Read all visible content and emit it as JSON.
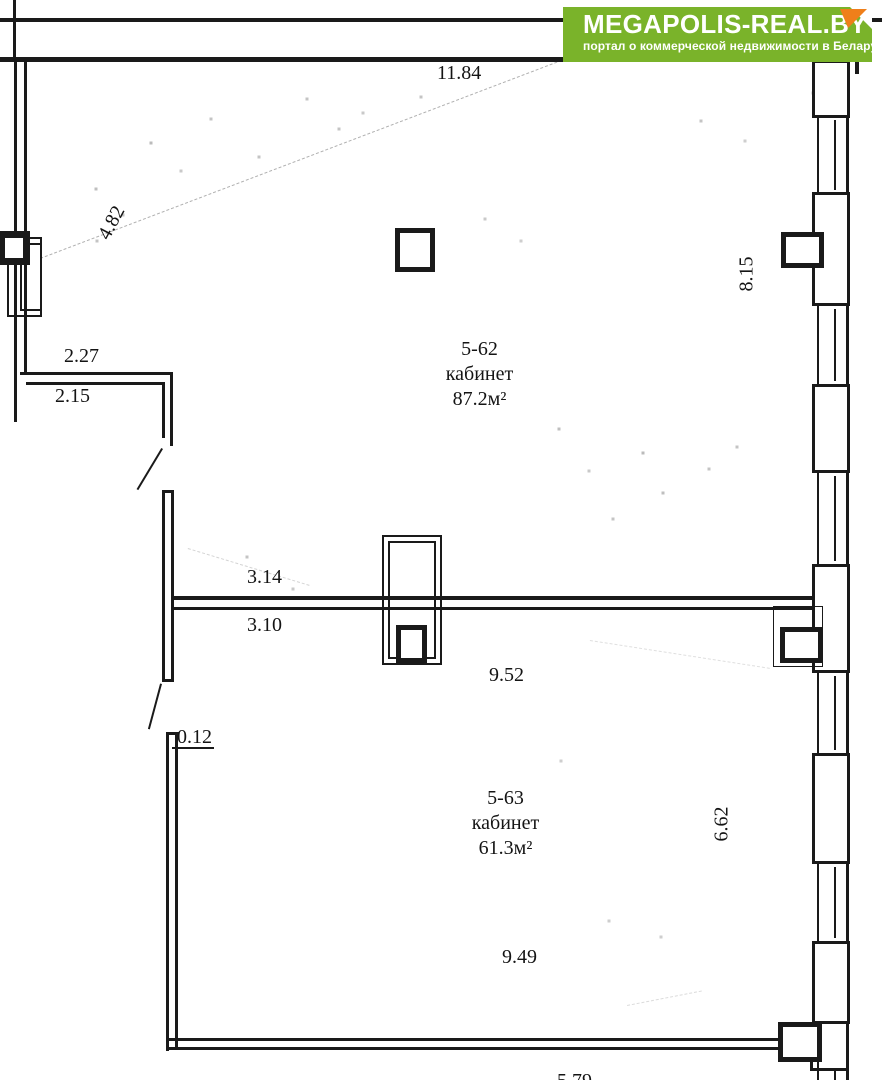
{
  "logo": {
    "title": "MEGAPOLIS-REAL.BY",
    "subtitle": "портал о коммерческой недвижимости в Беларуси",
    "background": "#7ab32a",
    "fold": "#ef7f1a"
  },
  "rooms": [
    {
      "number": "5-62",
      "label": "кабинет",
      "area": "87.2м²"
    },
    {
      "number": "5-63",
      "label": "кабинет",
      "area": "61.3м²"
    }
  ],
  "dimensions": {
    "top_wall": "11.84",
    "left_wall_upper": "4.82",
    "alcove_outer": "2.27",
    "alcove_inner": "2.15",
    "right_wall_upper": "8.15",
    "divider_north": "3.14",
    "divider_south": "3.10",
    "room_5_62_width": "9.52",
    "wall_offset": "0.12",
    "right_wall_lower": "6.62",
    "room_5_63_width": "9.49",
    "bottom_wall": "5.79"
  },
  "colors": {
    "wall_line": "#1a1a1a",
    "background": "#ffffff"
  }
}
